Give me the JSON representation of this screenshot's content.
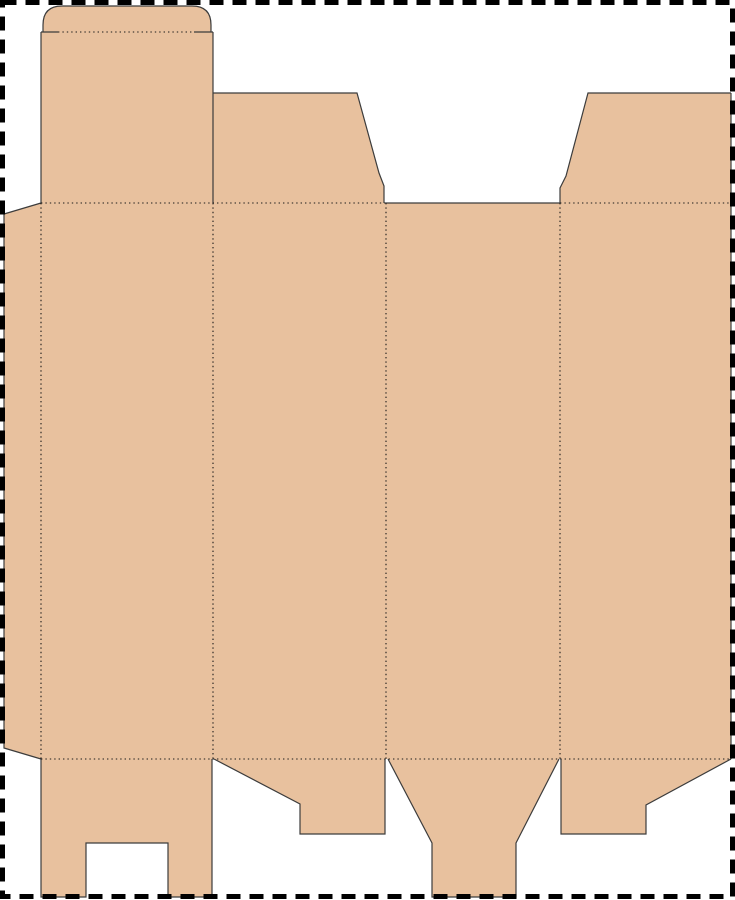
{
  "document": {
    "kind": "box-dieline-template",
    "description": "Flat die-cut template of a tuck-top folding carton: four body panels, glue tab, top tuck flap with crease slits, two top dust flaps, four bottom flaps, dashed sheet border"
  },
  "canvas": {
    "width": 735,
    "height": 900,
    "background": "#ffffff"
  },
  "page_border": {
    "color": "#000000",
    "stroke_width": 5,
    "dash": "14 9",
    "x": 2.5,
    "y": 2.5,
    "w": 730,
    "h": 894
  },
  "dieline": {
    "fill_color": "#e8c19e",
    "cut_color": "#3c3c3c",
    "cut_width": 1.2,
    "fold_color": "#1a1a1a",
    "fold_width": 1.1,
    "fold_dash": "1.4 3",
    "pieces": [
      {
        "name": "tuck-flap",
        "path": "M43,32 V25 Q43,6 62,6 H192 Q211,6 211,25 V32 Z"
      },
      {
        "name": "tuck-panel",
        "path": "M41,32 H213 V203 H41 Z"
      },
      {
        "name": "top-dust-flap-left",
        "path": "M213,93 H357 L379,173 L384,186 V203 H213 Z"
      },
      {
        "name": "top-dust-flap-right",
        "path": "M588,93 H731 V203 H560 V188 L566,176 Z"
      },
      {
        "name": "glue-tab",
        "path": "M41,203 L4,214 V748 L41,759 Z"
      },
      {
        "name": "body-panels",
        "path": "M41,203 H731 V759 H41 Z"
      },
      {
        "name": "bottom-flap-1",
        "path": "M41,759 H212 V897 H168 V843 H86 V897 H41 Z"
      },
      {
        "name": "bottom-flap-2",
        "path": "M214,759 H385 V834 H300 V804 Z"
      },
      {
        "name": "bottom-flap-3",
        "path": "M388,759 H559 L516,843 V897 H432 V843 Z"
      },
      {
        "name": "bottom-flap-4",
        "path": "M561,759 H731 L646,805 V834 H561 Z"
      }
    ],
    "cut_lines": [
      {
        "name": "crease-slit-left-cut",
        "path": "M41,32 H58"
      },
      {
        "name": "crease-slit-right-cut",
        "path": "M194,32 H213"
      },
      {
        "name": "tuck-flap-outline-cut",
        "path": "M43,32 V25 Q43,6 62,6 H192 Q211,6 211,25 V32"
      },
      {
        "name": "tuck-panel-left-edge-cut",
        "path": "M41,32 V203"
      },
      {
        "name": "tuck-panel-right-edge-cut",
        "path": "M213,32 V203"
      },
      {
        "name": "top-dust-flap-left-cut",
        "path": "M213,93 H357 L379,173 L384,186 V203"
      },
      {
        "name": "top-dust-flap-right-cut",
        "path": "M560,203 V188 L566,176 L588,93 H731"
      },
      {
        "name": "open-top-edge-cut",
        "path": "M385,203 H560"
      },
      {
        "name": "right-outer-edge-cut",
        "path": "M731,93 V759"
      },
      {
        "name": "glue-tab-outline-cut",
        "path": "M41,203 L4,214 V748 L41,759"
      },
      {
        "name": "bottom-flap-1-outline-cut",
        "path": "M41,759 V897 H86 V843 H168 V897 H212 V759"
      },
      {
        "name": "bottom-flap-2-outline-cut",
        "path": "M214,759 L300,804 V834 H385 V759"
      },
      {
        "name": "bottom-flap-3-outline-cut",
        "path": "M388,759 L432,843 V897 H516 V843 L559,759"
      },
      {
        "name": "bottom-flap-4-outline-cut",
        "path": "M561,759 V834 H646 V805 L731,759"
      }
    ],
    "fold_lines": [
      {
        "name": "top-fold-left-segment",
        "path": "M41,203 H385"
      },
      {
        "name": "top-fold-right-segment",
        "path": "M560,203 H731"
      },
      {
        "name": "bottom-fold",
        "path": "M41,759 H731"
      },
      {
        "name": "glue-tab-fold",
        "path": "M41,203 V759"
      },
      {
        "name": "panel-fold-1",
        "path": "M213,203 V759"
      },
      {
        "name": "panel-fold-2",
        "path": "M386,203 V759"
      },
      {
        "name": "panel-fold-3",
        "path": "M560,203 V759"
      },
      {
        "name": "tuck-crease-fold",
        "path": "M58,32 H194"
      }
    ]
  }
}
